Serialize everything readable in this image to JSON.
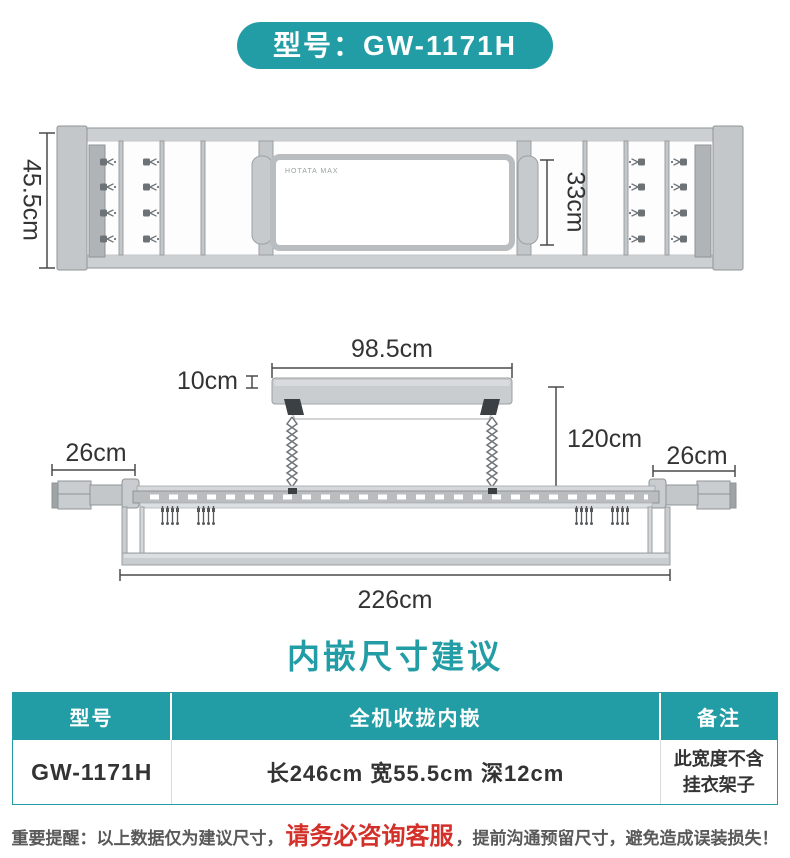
{
  "colors": {
    "accent_teal": "#239DA5",
    "warning_red": "#D3302A",
    "dimension_text": "#333333",
    "note_gray": "#595959",
    "drawing_gray": "#C9CDCF"
  },
  "badge": {
    "label": "型号：GW-1171H"
  },
  "top_view": {
    "height_label": "45.5cm",
    "panel_depth_label": "33cm",
    "brand_label": "HOTATA MAX"
  },
  "front_view": {
    "host_width_label": "98.5cm",
    "host_thickness_label": "10cm",
    "drop_height_label": "120cm",
    "left_arm_label": "26cm",
    "right_arm_label": "26cm",
    "total_width_label": "226cm"
  },
  "section_title": "内嵌尺寸建议",
  "table": {
    "headers": [
      "型号",
      "全机收拢内嵌",
      "备注"
    ],
    "row": {
      "model": "GW-1171H",
      "dimensions": "长246cm 宽55.5cm 深12cm",
      "note": "此宽度不含挂衣架子"
    }
  },
  "footer": {
    "prefix": "重要提醒：以上数据仅为建议尺寸，",
    "highlight": "请务必咨询客服",
    "suffix": "，提前沟通预留尺寸，避免造成误装损失！"
  }
}
